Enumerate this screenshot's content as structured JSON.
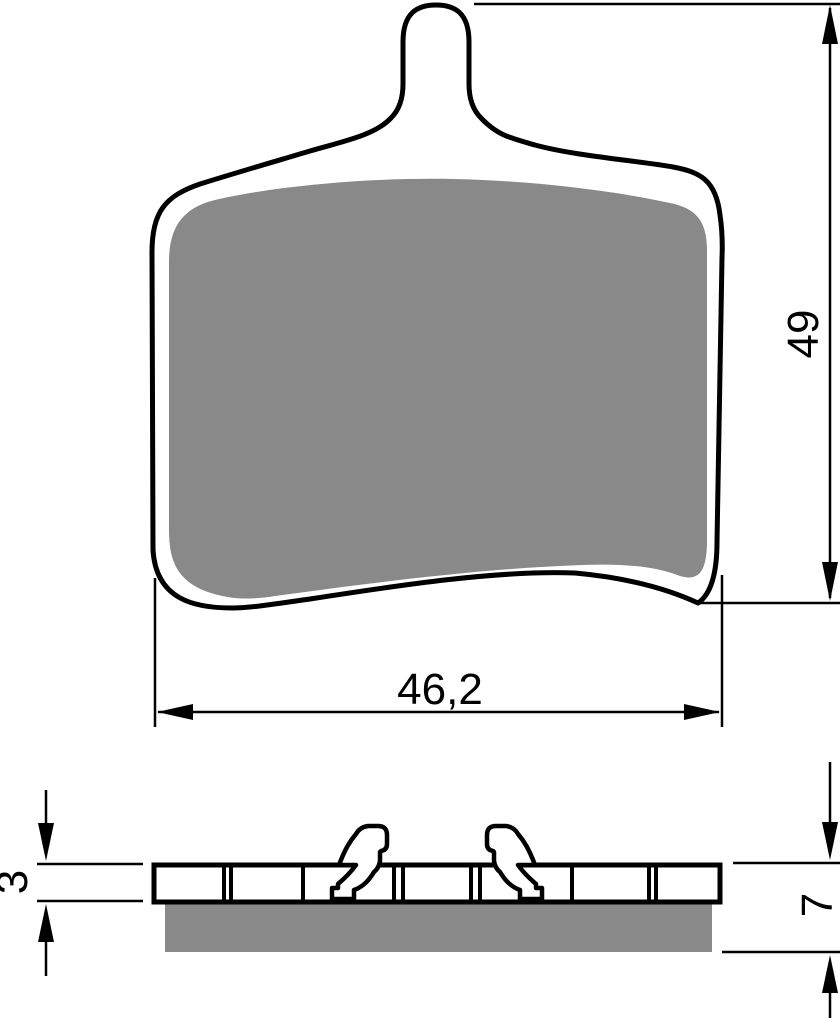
{
  "drawing": {
    "type": "brake-pad-technical-drawing",
    "dimensions": {
      "pad_width": "46,2",
      "pad_height": "49",
      "backplate_thickness": "3",
      "total_thickness": "7"
    },
    "colors": {
      "friction_material": "#898989",
      "outline": "#000000",
      "background": "#ffffff"
    }
  }
}
